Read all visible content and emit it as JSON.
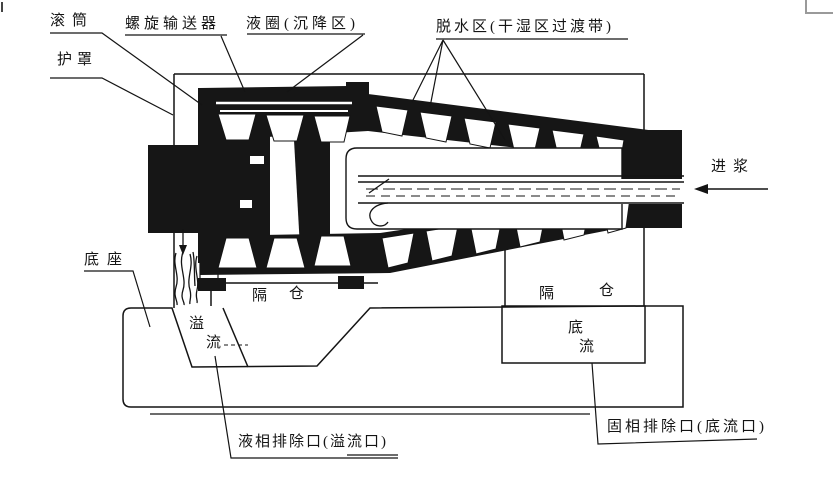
{
  "page": {
    "background": "#ffffff",
    "ink": "#141414",
    "corner_mark_color": "#9a9a9a"
  },
  "diagram": {
    "type": "decanter-centrifuge-cross-section",
    "labels": {
      "drum": "滚筒",
      "screw_conveyor": "螺旋输送器",
      "liquid_ring": "液圈(沉降区)",
      "dewatering_zone": "脱水区(干湿区过渡带)",
      "cover": "护罩",
      "feed": "进浆",
      "base": "底座",
      "compartment_left": {
        "char1": "隔",
        "char2": "仓"
      },
      "compartment_right": {
        "char1": "隔",
        "char2": "仓"
      },
      "overflow": {
        "char1": "溢",
        "char2": "流"
      },
      "underflow": {
        "char1": "底",
        "char2": "流"
      },
      "liquid_outlet": "液相排除口(溢流口)",
      "solid_outlet": "固相排除口(底流口)"
    }
  }
}
